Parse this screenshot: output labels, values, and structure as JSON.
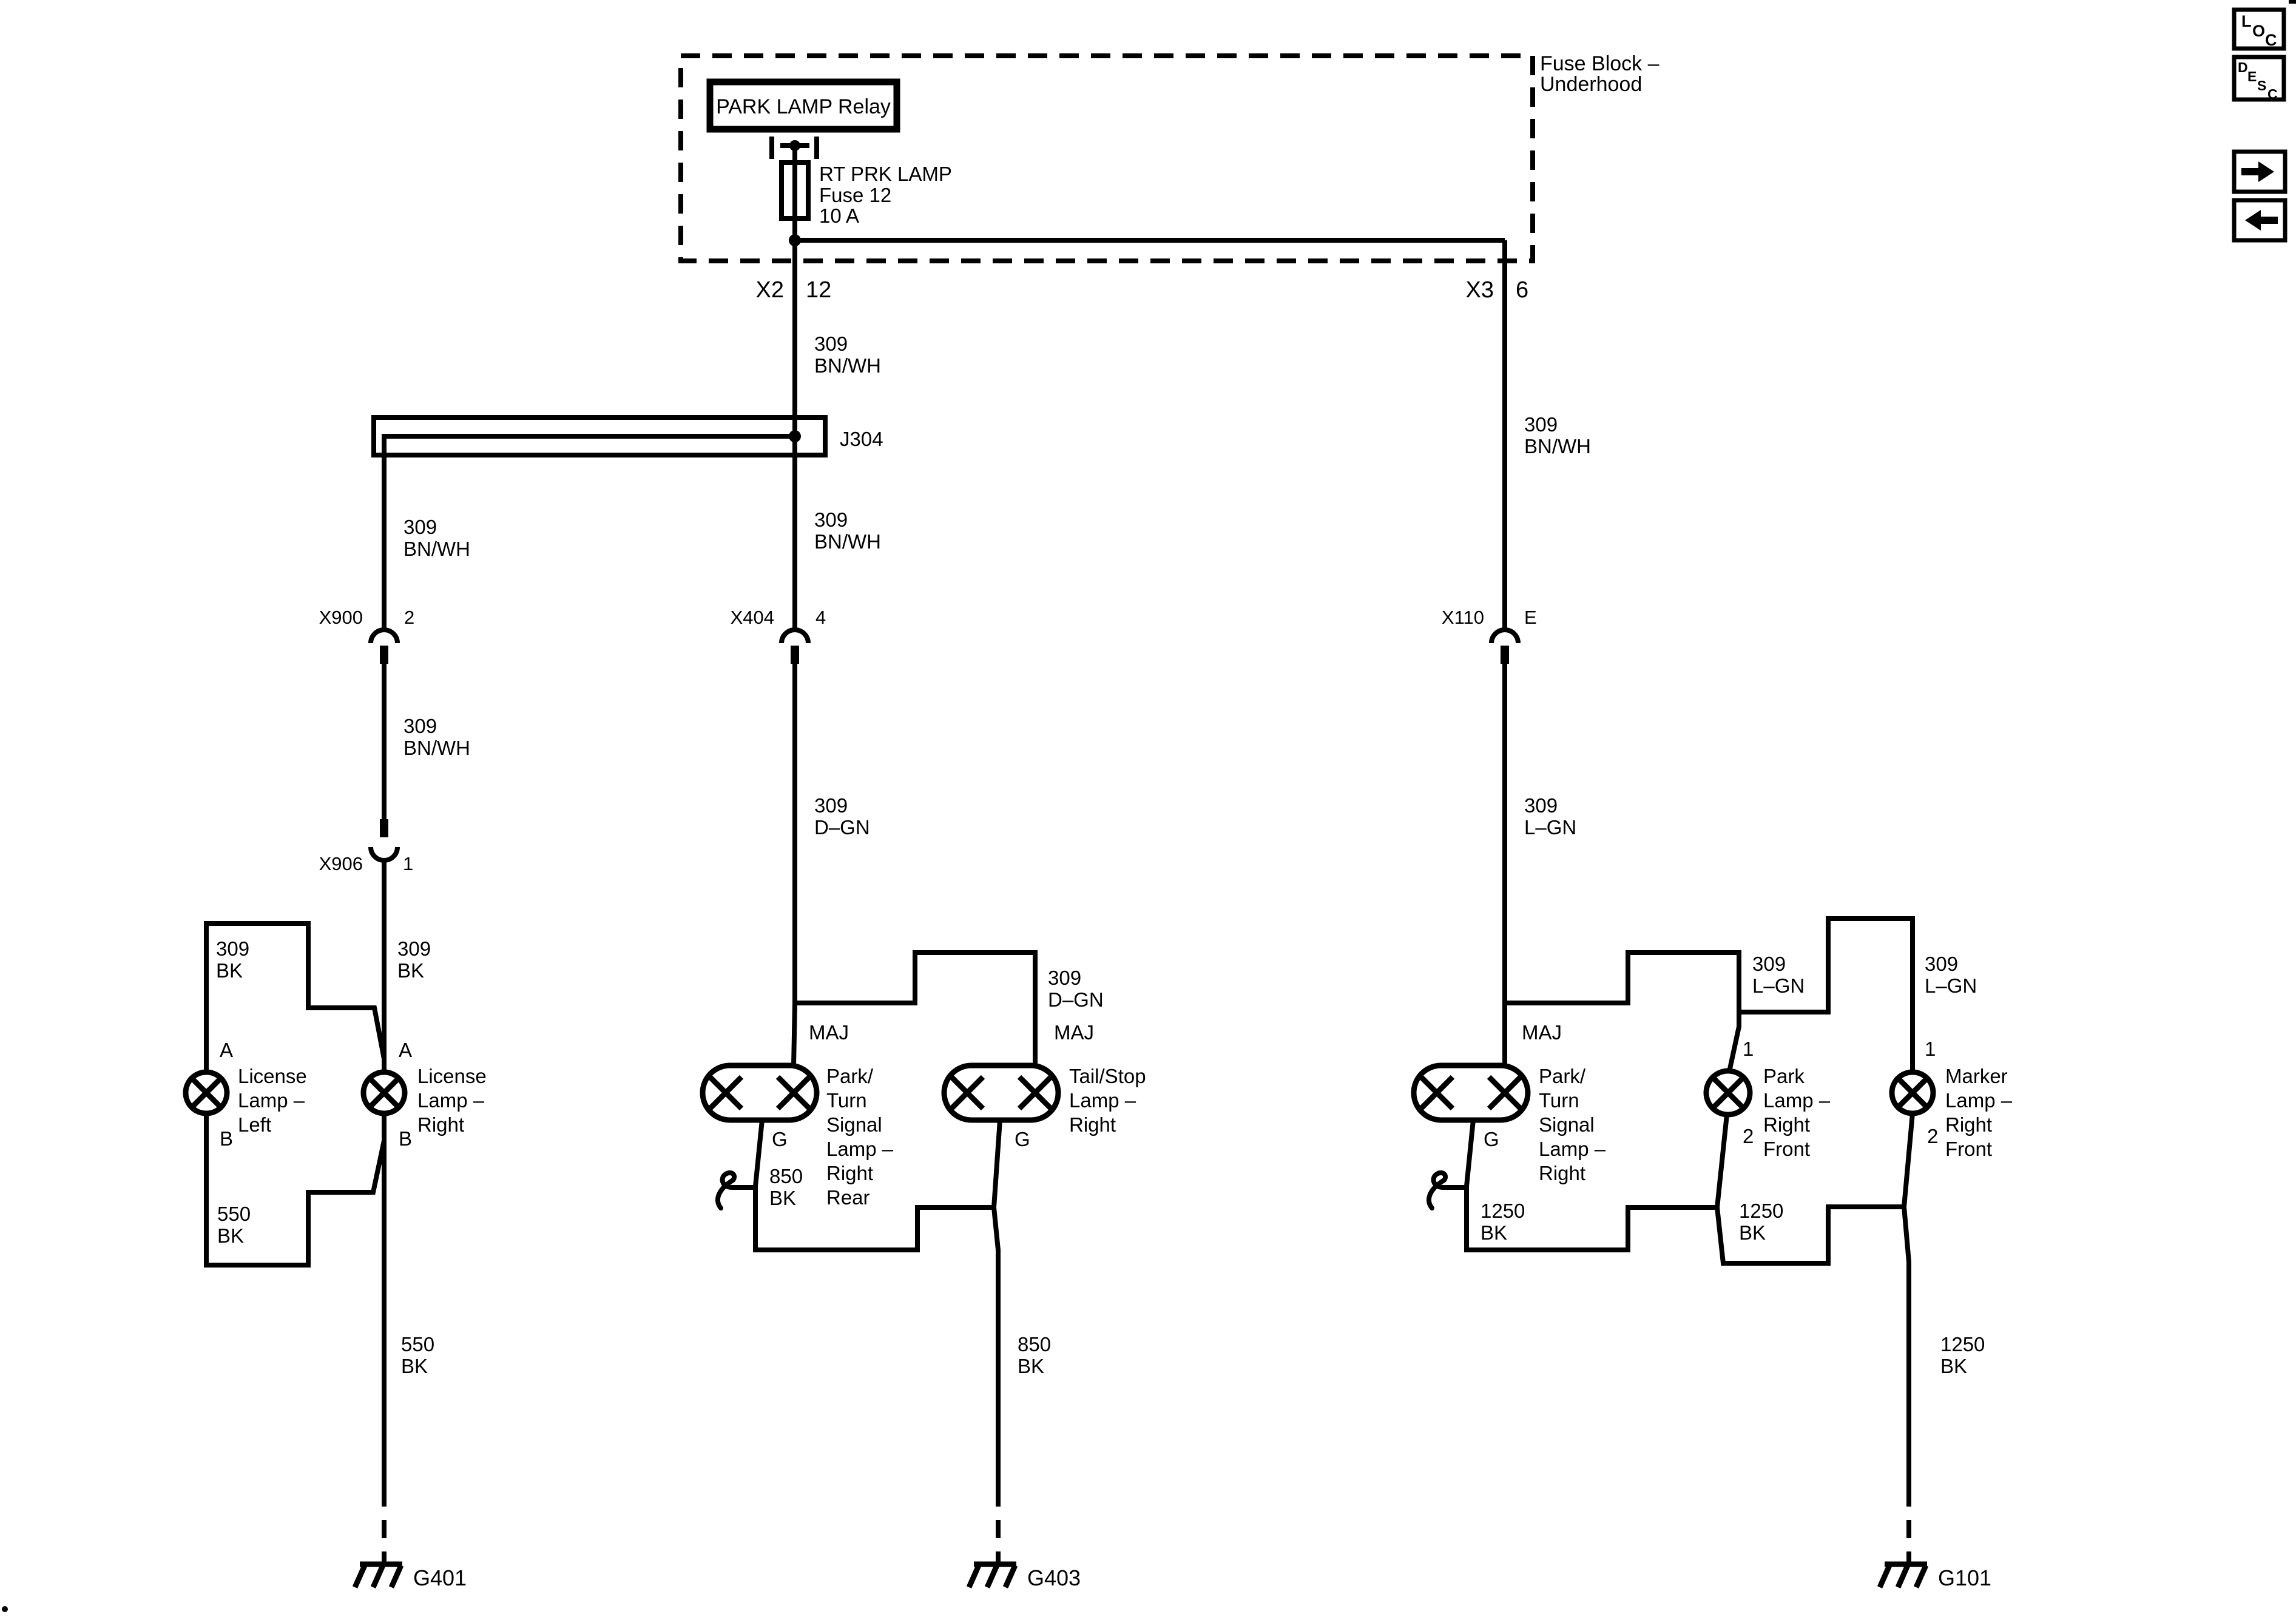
{
  "colors": {
    "ink": "#000000",
    "background": "#ffffff"
  },
  "diagram": {
    "fuse_block": {
      "title": [
        "Fuse Block –",
        "Underhood"
      ],
      "relay": "PARK LAMP Relay",
      "fuse": [
        "RT PRK LAMP",
        "Fuse 12",
        "10 A"
      ],
      "conn_left": {
        "name": "X2",
        "pin": "12"
      },
      "conn_right": {
        "name": "X3",
        "pin": "6"
      }
    },
    "j304": "J304",
    "connectors": {
      "x900": {
        "name": "X900",
        "pin": "2"
      },
      "x906": {
        "name": "X906",
        "pin": "1"
      },
      "x404": {
        "name": "X404",
        "pin": "4"
      },
      "x110": {
        "name": "X110",
        "pin": "E"
      }
    },
    "wire_labels": {
      "x2_feed": [
        "309",
        "BN/WH"
      ],
      "x3_feed": [
        "309",
        "BN/WH"
      ],
      "j304_left": [
        "309",
        "BN/WH"
      ],
      "x404_feed": [
        "309",
        "BN/WH"
      ],
      "x900_x906": [
        "309",
        "BN/WH"
      ],
      "x404_out": [
        "309",
        "D–GN"
      ],
      "tailstop_branch": [
        "309",
        "D–GN"
      ],
      "x110_feed": [
        "309",
        "L–GN"
      ],
      "parklamp_branch": [
        "309",
        "L–GN"
      ],
      "marker_branch": [
        "309",
        "L–GN"
      ],
      "license_left": [
        "309",
        "BK"
      ],
      "license_right": [
        "309",
        "BK"
      ],
      "license_left_gnd": [
        "550",
        "BK"
      ],
      "license_gnd": [
        "550",
        "BK"
      ],
      "parkturn_rear_gnd": [
        "850",
        "BK"
      ],
      "rear_gnd": [
        "850",
        "BK"
      ],
      "parkturn_front_gnd": [
        "1250",
        "BK"
      ],
      "parkfront_gnd": [
        "1250",
        "BK"
      ],
      "front_gnd": [
        "1250",
        "BK"
      ]
    },
    "lamps": {
      "license_left": {
        "lines": [
          "License",
          "Lamp –",
          "Left"
        ],
        "t_top": "A",
        "t_bottom": "B"
      },
      "license_right": {
        "lines": [
          "License",
          "Lamp –",
          "Right"
        ],
        "t_top": "A",
        "t_bottom": "B"
      },
      "parkturn_rear": {
        "lines": [
          "Park/",
          "Turn",
          "Signal",
          "Lamp –",
          "Right",
          "Rear"
        ],
        "t_top": "MAJ",
        "t_bottom": "G"
      },
      "tailstop": {
        "lines": [
          "Tail/Stop",
          "Lamp –",
          "Right"
        ],
        "t_top": "MAJ",
        "t_bottom": "G"
      },
      "parkturn_front": {
        "lines": [
          "Park/",
          "Turn",
          "Signal",
          "Lamp –",
          "Right"
        ],
        "t_top": "MAJ",
        "t_bottom": "G"
      },
      "park_front": {
        "lines": [
          "Park",
          "Lamp –",
          "Right",
          "Front"
        ],
        "t_top": "1",
        "t_bottom": "2"
      },
      "marker_front": {
        "lines": [
          "Marker",
          "Lamp –",
          "Right",
          "Front"
        ],
        "t_top": "1",
        "t_bottom": "2"
      }
    },
    "grounds": {
      "g401": "G401",
      "g403": "G403",
      "g101": "G101"
    }
  },
  "sidebar": {
    "loc": [
      "L",
      "O",
      "C"
    ],
    "desc": [
      "D",
      "E",
      "S",
      "C"
    ],
    "next_icon": "right-arrow",
    "prev_icon": "left-arrow"
  }
}
